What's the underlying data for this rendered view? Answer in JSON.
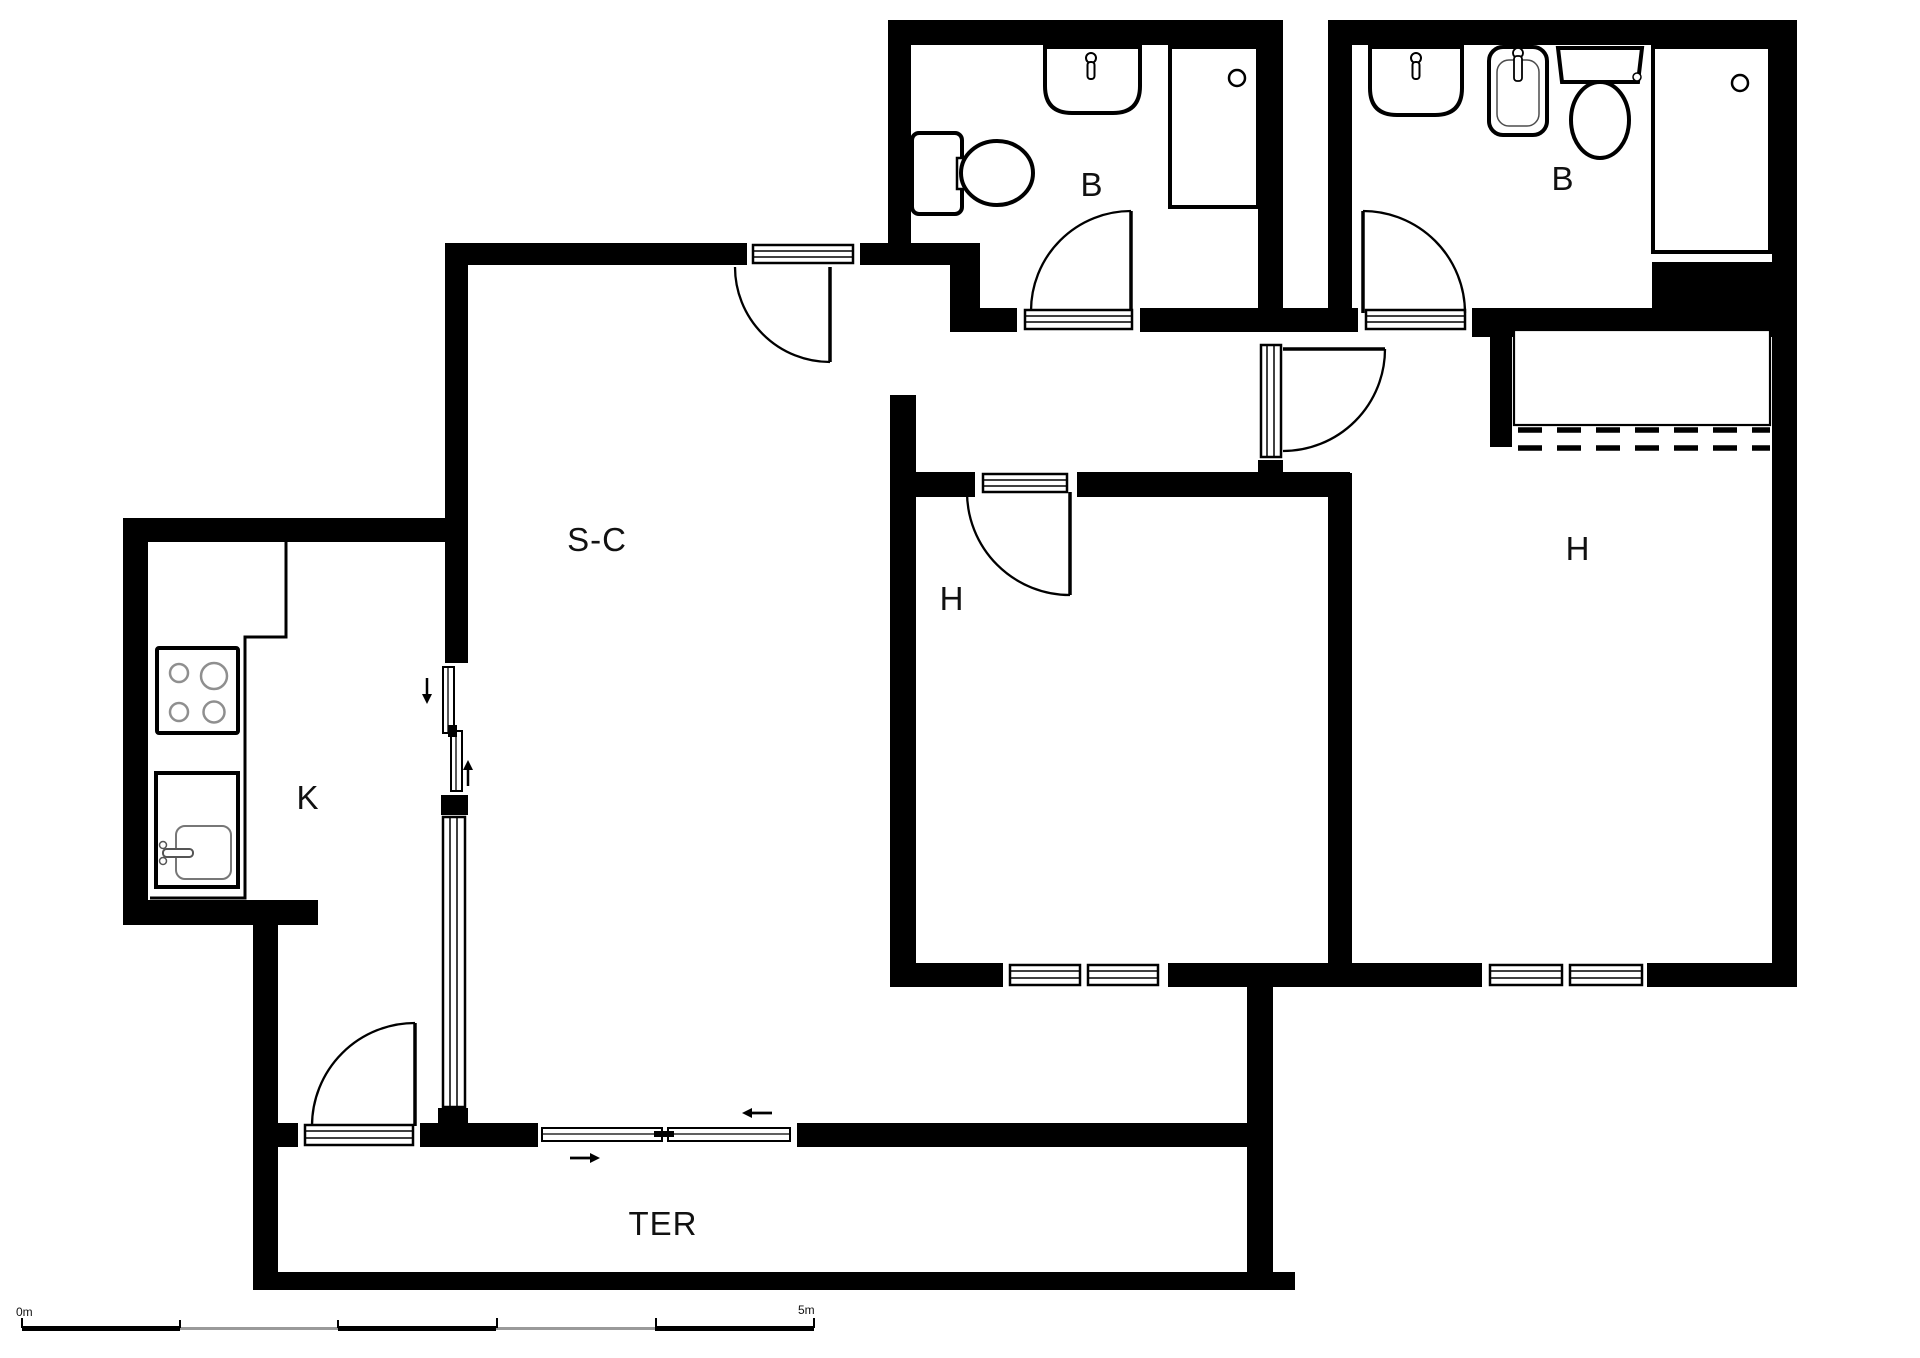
{
  "plan_type": "apartment floor plan",
  "rooms": {
    "bathroom1": {
      "label": "B",
      "fixtures": [
        "toilet",
        "washbasin",
        "shower-tray"
      ]
    },
    "bathroom2": {
      "label": "B",
      "fixtures": [
        "washbasin",
        "bidet",
        "toilet",
        "shower-tray"
      ]
    },
    "living_room": {
      "label": "S-C",
      "features": [
        "entry-door",
        "sliding-door-to-terrace",
        "side-window"
      ]
    },
    "kitchen": {
      "label": "K",
      "fixtures": [
        "stove-4-burners",
        "kitchen-sink",
        "counter"
      ]
    },
    "bedroom_center": {
      "label": "H",
      "features": [
        "door",
        "window"
      ]
    },
    "bedroom_right": {
      "label": "H",
      "features": [
        "door",
        "wardrobe-dashed",
        "window"
      ]
    },
    "terrace": {
      "label": "TER",
      "features": [
        "door-to-kitchen-hall",
        "sliding-door-to-living"
      ]
    }
  },
  "scalebar": {
    "start": "0m",
    "end": "5m",
    "segments": 5
  },
  "colors": {
    "wall": "#000000",
    "background": "#ffffff",
    "light_detail": "#8f8f8f"
  }
}
